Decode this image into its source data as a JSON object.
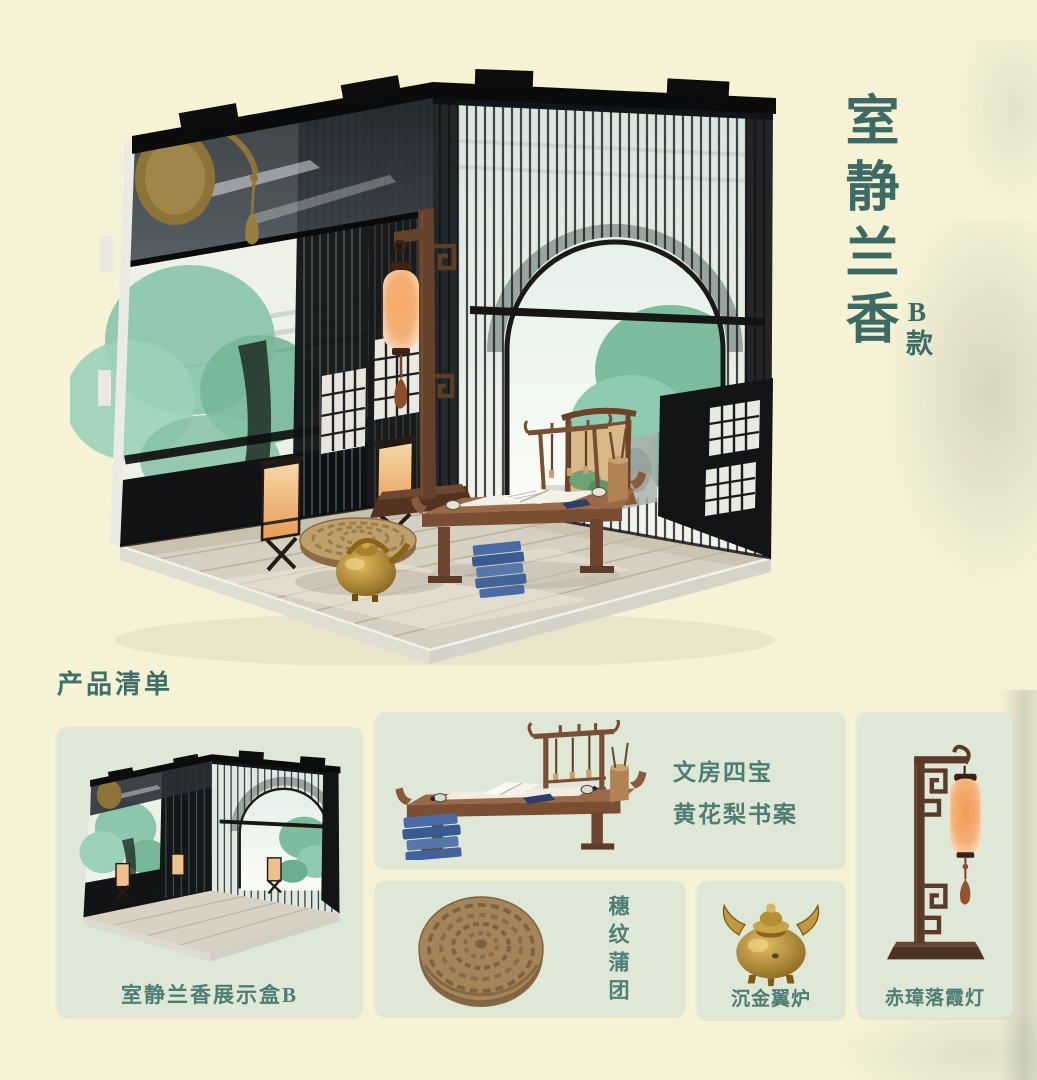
{
  "title": {
    "main": "室静兰香",
    "variant": "B款"
  },
  "section": {
    "heading": "产品清单"
  },
  "products": {
    "display_box": {
      "caption": "室静兰香展示盒B"
    },
    "desk": {
      "label_line1": "文房四宝",
      "label_line2": "黄花梨书案"
    },
    "cushion": {
      "label": "穗纹蒲团"
    },
    "censer": {
      "label": "沉金翼炉"
    },
    "lamp": {
      "label": "赤璋落霞灯"
    }
  },
  "colors": {
    "page_bg": "#f5f2d6",
    "panel_bg": "#dfe8d7",
    "accent_teal": "#3d6b64",
    "caption_teal": "#4d7d74",
    "lattice_black": "#141414",
    "wood_brown": "#5a3a28",
    "lantern_orange": "#f1975a",
    "brass_gold": "#b8922e",
    "tree_teal": "#7dbd9e"
  }
}
